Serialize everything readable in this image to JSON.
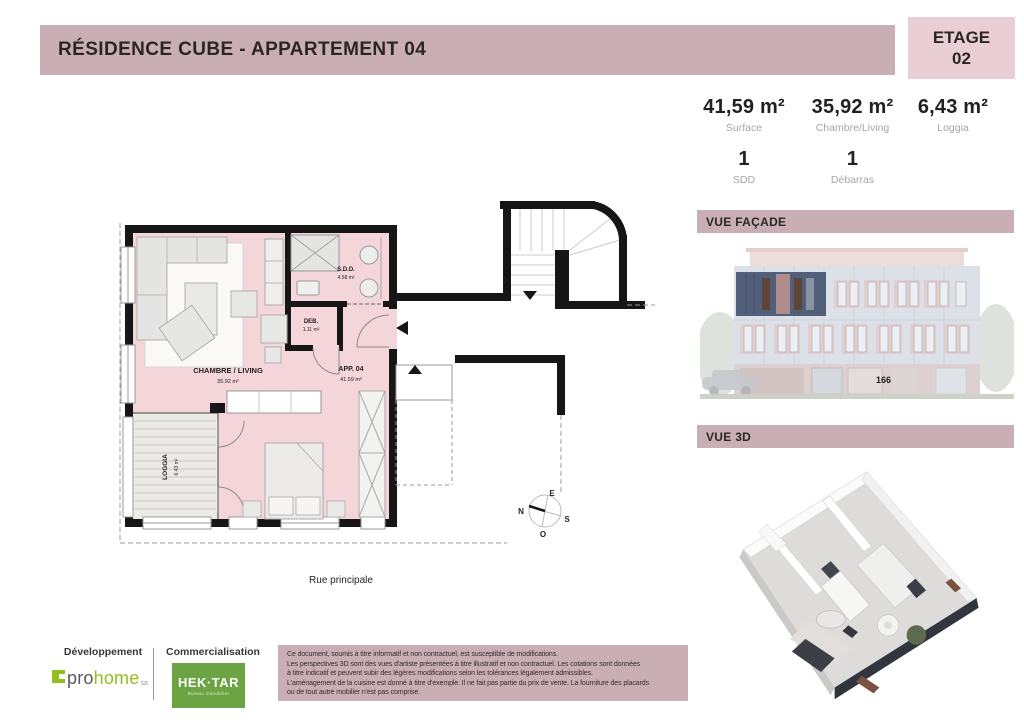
{
  "header": {
    "title": "RÉSIDENCE CUBE - APPARTEMENT 04",
    "etage_label": "ETAGE",
    "etage_value": "02"
  },
  "stats": {
    "row1": [
      {
        "value": "41,59 m²",
        "label": "Surface"
      },
      {
        "value": "35,92 m²",
        "label": "Chambre/Living"
      },
      {
        "value": "6,43 m²",
        "label": "Loggia"
      }
    ],
    "row2": [
      {
        "value": "1",
        "label": "SDD"
      },
      {
        "value": "1",
        "label": "Débarras"
      }
    ]
  },
  "sections": {
    "facade": "VUE FAÇADE",
    "vue3d": "VUE 3D"
  },
  "facade": {
    "street_number": "166"
  },
  "plan": {
    "rooms": {
      "living": {
        "name": "CHAMBRE / LIVING",
        "area": "35.92 m²"
      },
      "sdd": {
        "name": "S.D.D.",
        "area": "4.58 m²"
      },
      "deb": {
        "name": "DEB.",
        "area": "1.11 m²"
      },
      "app": {
        "name": "APP. 04",
        "area": "41.59 m²"
      },
      "loggia": {
        "name": "LOGGIA",
        "area": "6.43 m²"
      }
    },
    "street_label": "Rue principale",
    "compass": {
      "e": "E",
      "n": "N",
      "s": "S",
      "o": "O"
    }
  },
  "footer": {
    "development_label": "Développement",
    "brand_pro": "pro",
    "brand_home": "home",
    "brand_suffix": "sa",
    "commercialisation_label": "Commercialisation",
    "commercial_brand": "HEK·TAR",
    "commercial_sub": "Bureau Immobilier",
    "disclaimer": "Ce document, soumis à titre informatif et non contractuel, est susceptible de modifications.\nLes perspectives 3D sont des vues d'artiste présentées à titre illustratif et non contractuel. Les cotations sont données\nà titre indicatif et peuvent subir des légères modifications selon les tolérances légalement admissibles.\nL'aménagement de la cuisine est donné à titre d'exemple. Il ne fait pas partie du prix de vente. La fourniture des placards\nou de tout autre mobilier n'est pas comprise."
  },
  "colors": {
    "accent": "#c9aeb6",
    "badge": "#e9ced5",
    "plan-pink": "#f4d5d9",
    "logo-green": "#93c01f",
    "hektar-green": "#6ca444"
  }
}
